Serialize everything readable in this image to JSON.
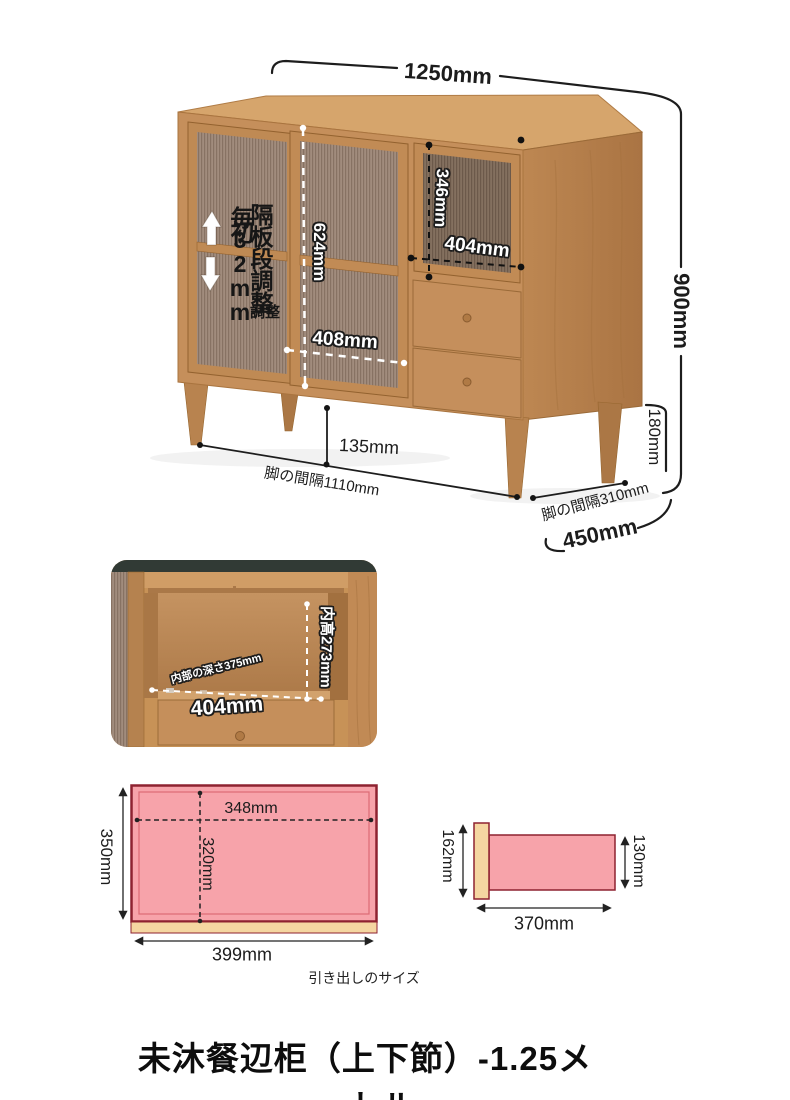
{
  "product": {
    "title": "未沐餐辺柜（上下節）-1.25メートル"
  },
  "overview": {
    "width": "1250mm",
    "height": "900mm",
    "depth": "450mm",
    "leg_height": "180mm",
    "floor_clearance": "135mm",
    "front_leg_span": "脚の間隔1110mm",
    "side_leg_span": "脚の間隔310mm",
    "glass_door_height": "624mm",
    "glass_door_width": "408mm",
    "flip_door_height": "346mm",
    "flip_door_width": "404mm",
    "shelf_note_column_a": "毎32mm",
    "shelf_note_column_a_overlay": "初",
    "shelf_note_column_b": "隔板段調整",
    "shelf_note_footnote": "調整"
  },
  "interior_view": {
    "inner_height": "内高273mm",
    "inner_depth": "内部の深さ375mm",
    "inner_width": "404mm"
  },
  "drawer_front_view": {
    "outer_height": "350mm",
    "outer_width": "399mm",
    "inner_width": "348mm",
    "inner_depth": "320mm"
  },
  "drawer_side_view": {
    "front_panel_height": "162mm",
    "box_height": "130mm",
    "box_length": "370mm"
  },
  "captions": {
    "drawer_size": "引き出しのサイズ"
  },
  "colors": {
    "pink_fill": "#f7a3aa",
    "outline_red": "#8e2230",
    "beige": "#f5d6a1",
    "wood": "#c58f5b",
    "backdrop": "#313a35"
  }
}
